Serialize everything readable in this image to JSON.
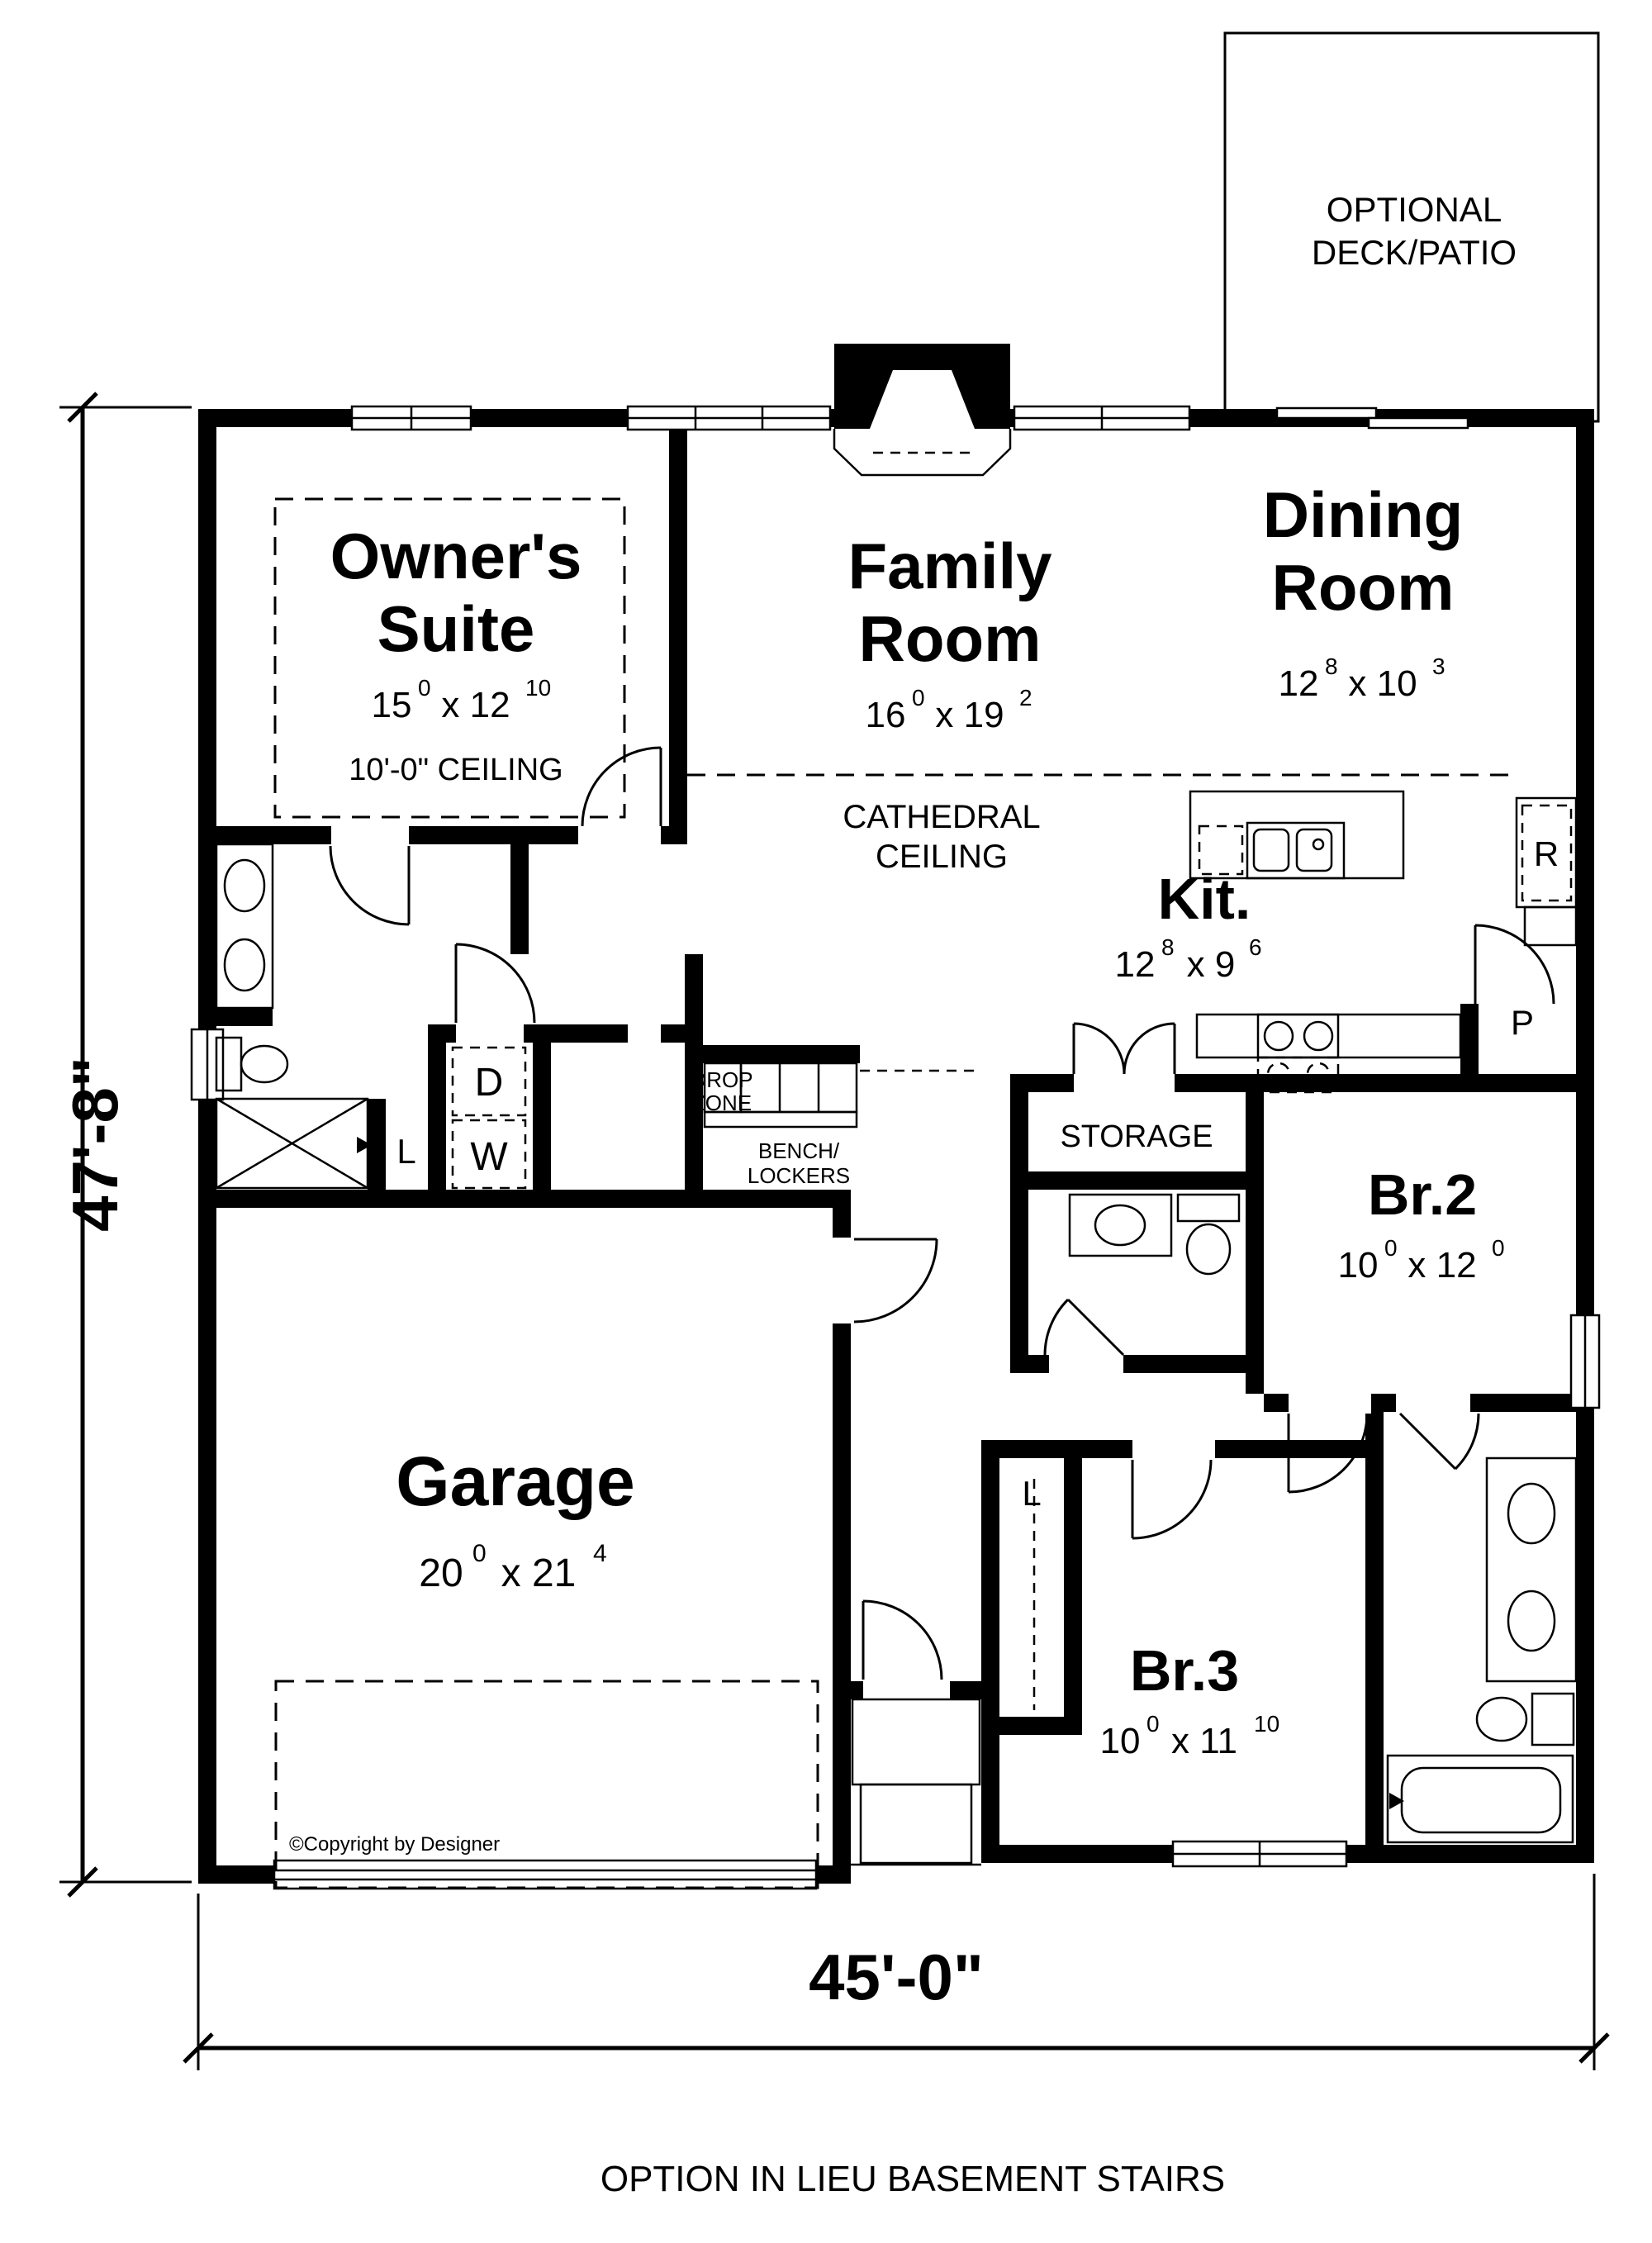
{
  "deck": {
    "line1": "OPTIONAL",
    "line2": "DECK/PATIO"
  },
  "owners": {
    "line1": "Owner's",
    "line2": "Suite",
    "dim": {
      "a": "15",
      "as": "0",
      "b": "x 12",
      "bs": "10"
    },
    "ceiling": "10'-0\" CEILING"
  },
  "family": {
    "line1": "Family",
    "line2": "Room",
    "dim": {
      "a": "16",
      "as": "0",
      "b": "x 19",
      "bs": "2"
    }
  },
  "dining": {
    "line1": "Dining",
    "line2": "Room",
    "dim": {
      "a": "12",
      "as": "8",
      "b": "x 10",
      "bs": "3"
    }
  },
  "cathedral": {
    "line1": "CATHEDRAL",
    "line2": "CEILING"
  },
  "kitchen": {
    "name": "Kit.",
    "dim": {
      "a": "12",
      "as": "8",
      "b": "x 9",
      "bs": "6"
    },
    "fridge": "R",
    "pantry": "P"
  },
  "storage": {
    "name": "STORAGE"
  },
  "br2": {
    "name": "Br.2",
    "dim": {
      "a": "10",
      "as": "0",
      "b": "x 12",
      "bs": "0"
    }
  },
  "br3": {
    "name": "Br.3",
    "dim": {
      "a": "10",
      "as": "0",
      "b": "x 11",
      "bs": "10"
    },
    "closet": "L"
  },
  "garage": {
    "name": "Garage",
    "dim": {
      "a": "20",
      "as": "0",
      "b": "x 21",
      "bs": "4"
    }
  },
  "mud": {
    "drop1": "DROP",
    "drop2": "ZONE",
    "bench1": "BENCH/",
    "bench2": "LOCKERS",
    "dryer": "D",
    "washer": "W",
    "linen": "L"
  },
  "annotations": {
    "copyright": "©Copyright by Designer",
    "width": "45'-0\"",
    "height": "47'-8\"",
    "note": "OPTION IN LIEU BASEMENT STAIRS"
  }
}
